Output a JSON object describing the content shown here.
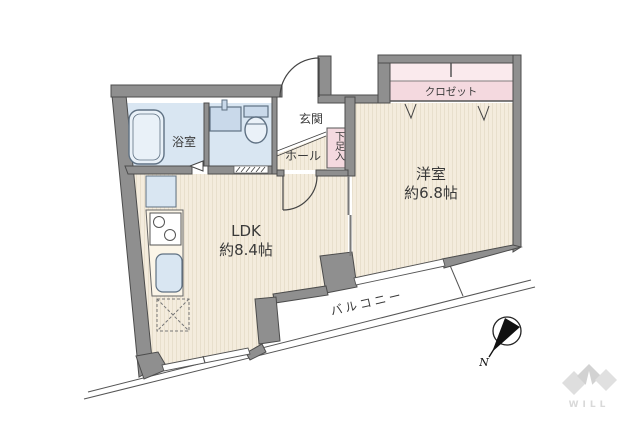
{
  "colors": {
    "wall": "#8f8f8f",
    "wall_edge": "#4c4c4c",
    "floor": "#f4ecdd",
    "floor_stripe": "#e8dfcc",
    "wet": "#d9e6f2",
    "wet_fixture": "#c9d9ea",
    "fixture_line": "#5f7183",
    "pink": "#f4d9df",
    "pink_light": "#faeaed",
    "counter": "#fbf5e8",
    "line": "#444444",
    "logo": "#d9d9d9"
  },
  "rooms": {
    "bathroom": {
      "label": "浴室"
    },
    "entrance": {
      "label": "玄関"
    },
    "hall": {
      "label": "ホール"
    },
    "shoe_cabinet": {
      "label": "下足入"
    },
    "closet": {
      "label": "クロゼット"
    },
    "western_room": {
      "label": "洋室",
      "size": "約6.8帖"
    },
    "ldk": {
      "label": "LDK",
      "size": "約8.4帖"
    },
    "balcony": {
      "label": "バルコニー"
    }
  },
  "compass": {
    "north": "N"
  },
  "logo": {
    "text": "WILL"
  }
}
